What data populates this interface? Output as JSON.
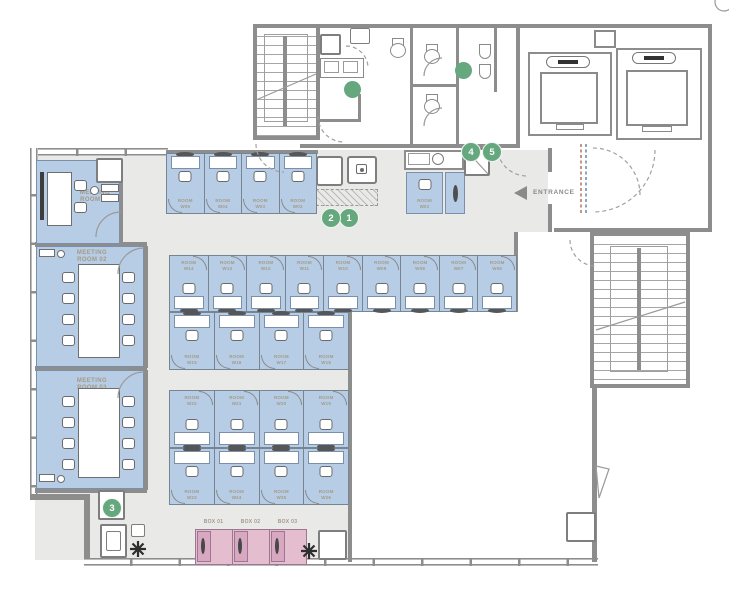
{
  "legend": {
    "entrance_label": "ENTRANCE"
  },
  "meeting_rooms": [
    {
      "line1": "MEETING",
      "line2": "ROOM 01"
    },
    {
      "line1": "MEETING",
      "line2": "ROOM 02"
    },
    {
      "line1": "MEETING",
      "line2": "ROOM 03"
    }
  ],
  "booths": {
    "entrance_booth": "ROOM W01",
    "top_row": [
      "ROOM W05",
      "ROOM W04",
      "ROOM W03",
      "ROOM W02"
    ],
    "mid_top_row": [
      "ROOM W14",
      "ROOM W13",
      "ROOM W12",
      "ROOM W11",
      "ROOM W10",
      "ROOM W09",
      "ROOM W08",
      "ROOM W07",
      "ROOM W06"
    ],
    "mid_bottom_row": [
      "ROOM W15",
      "ROOM W16",
      "ROOM W17",
      "ROOM W18"
    ],
    "lower_top_row": [
      "ROOM W22",
      "ROOM W21",
      "ROOM W20",
      "ROOM W19"
    ],
    "lower_bottom_row": [
      "ROOM W23",
      "ROOM W24",
      "ROOM W25",
      "ROOM W26"
    ]
  },
  "phone_boxes": [
    "BOX 01",
    "BOX 02",
    "BOX 03"
  ],
  "markers": [
    {
      "number": "1"
    },
    {
      "number": "2"
    },
    {
      "number": "3"
    },
    {
      "number": "4"
    },
    {
      "number": "5"
    }
  ],
  "colors": {
    "booth_blue": "#b7cde5",
    "box_pink": "#e4bdcf",
    "marker_green": "#66a87e",
    "wall_gray": "#8d8d8d",
    "floor_gray": "#e9e9e7",
    "label_tan": "#a39a86"
  }
}
